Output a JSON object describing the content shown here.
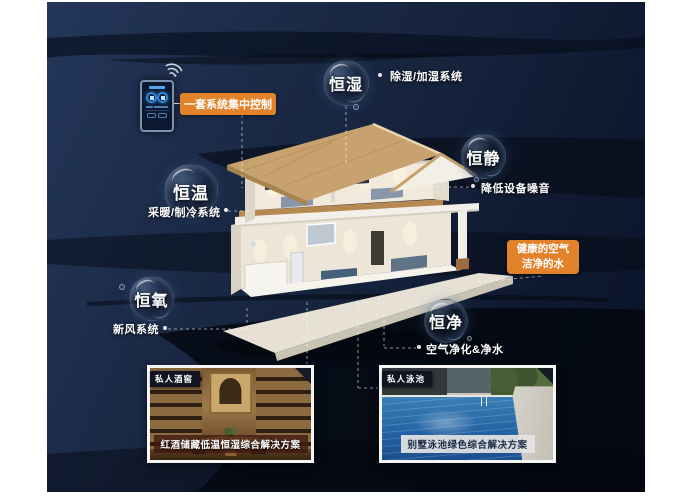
{
  "control": {
    "label": "一套系统集中控制"
  },
  "features": [
    {
      "id": "humidity",
      "bubble": "恒湿",
      "label": "除湿/加湿系统"
    },
    {
      "id": "quiet",
      "bubble": "恒静",
      "label": "降低设备噪音"
    },
    {
      "id": "temperature",
      "bubble": "恒温",
      "label": "采暖/制冷系统"
    },
    {
      "id": "oxygen",
      "bubble": "恒氧",
      "label": "新风系统"
    },
    {
      "id": "purity",
      "bubble": "恒净",
      "label": "空气净化&净水"
    }
  ],
  "highlight": {
    "line1": "健康的空气",
    "line2": "洁净的水"
  },
  "cards": [
    {
      "badge": "私人酒窖",
      "caption": "红酒储藏低温恒湿综合解决方案"
    },
    {
      "badge": "私人泳池",
      "caption": "别墅泳池绿色综合解决方案"
    }
  ],
  "icons": {
    "wifi": "wifi-icon"
  },
  "colors": {
    "accent_orange": "#e2832c",
    "background_navy": "#16233d",
    "text_light": "#ffffff"
  }
}
